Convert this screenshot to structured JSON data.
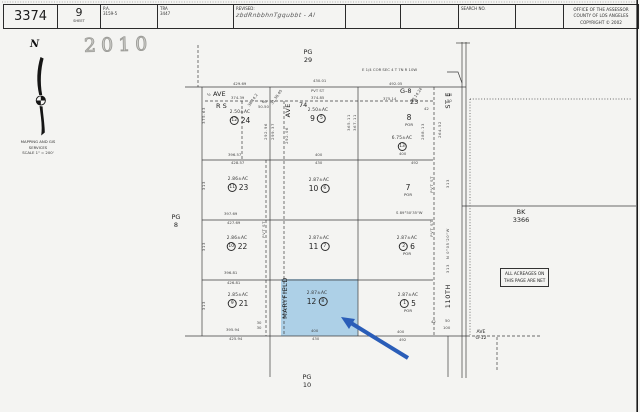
{
  "header": {
    "map_book": "3374",
    "sheet_number": "9",
    "sheet_label": "SHEET",
    "pa_label": "P.A.",
    "pa_value": "3159-5",
    "tra_label": "TRA",
    "tra_value": "3447",
    "revised_label": "REVISED:",
    "revised_note": "zbdRnbbhnTgqubbt - Al",
    "search_label": "SEARCH NO.",
    "office_line1": "OFFICE OF THE ASSESSOR",
    "office_line2": "COUNTY OF LOS ANGELES",
    "office_line3": "COPYRIGHT © 2002"
  },
  "stamp": "2010",
  "compass": {
    "n": "N",
    "caption": "MAPPING AND GIS\nSERVICES\nSCALE 1\" = 200'"
  },
  "note_box": "ALL ACREAGES ON\nTHIS PAGE ARE NET",
  "colors": {
    "highlight": "#a9cde6",
    "arrow": "#2a5db8",
    "line": "#3c3c3c"
  },
  "map": {
    "labels": [
      {
        "n": "pg-29",
        "t": "PG\n29",
        "x": 308,
        "y": 49,
        "c": "md ctr pre"
      },
      {
        "n": "pg-8",
        "t": "PG\n8",
        "x": 176,
        "y": 214,
        "c": "md ctr pre"
      },
      {
        "n": "pg-10",
        "t": "PG\n10",
        "x": 307,
        "y": 374,
        "c": "md ctr pre"
      },
      {
        "n": "bk-3366",
        "t": "BK\n3366",
        "x": 521,
        "y": 209,
        "c": "md ctr pre"
      },
      {
        "n": "ave-g12-label",
        "t": "AVE\nG-12",
        "x": 481,
        "y": 330,
        "c": "sm ctr pre"
      },
      {
        "n": "quarter-corner-note",
        "t": "E 1/4 COR SEC 4 T 7N R 10W",
        "x": 362,
        "y": 68,
        "c": "tiny"
      },
      {
        "n": "ave-west-prefix",
        "t": "½",
        "x": 207,
        "y": 93,
        "c": "tiny"
      },
      {
        "n": "ave-west-label",
        "t": "AVE",
        "x": 213,
        "y": 91,
        "c": "md"
      },
      {
        "n": "pvt-st-top",
        "t": "PVT ST",
        "x": 311,
        "y": 89,
        "c": "tiny"
      },
      {
        "n": "ave-g8-label",
        "t": "G-8",
        "x": 400,
        "y": 88,
        "c": "md"
      },
      {
        "n": "rs-note",
        "t": "R S",
        "x": 216,
        "y": 103,
        "c": "md"
      },
      {
        "n": "tract-74",
        "t": "74",
        "x": 299,
        "y": 102,
        "c": "md"
      },
      {
        "n": "lot-23-right",
        "t": "23",
        "x": 410,
        "y": 99,
        "c": "md"
      },
      {
        "n": "dim",
        "t": "429.69",
        "x": 233,
        "y": 82,
        "c": "tiny"
      },
      {
        "n": "dim",
        "t": "374.39",
        "x": 231,
        "y": 96,
        "c": "tiny"
      },
      {
        "n": "dim",
        "t": "430.01",
        "x": 313,
        "y": 79,
        "c": "tiny"
      },
      {
        "n": "dim",
        "t": "374.85",
        "x": 311,
        "y": 96,
        "c": "tiny"
      },
      {
        "n": "dim",
        "t": "492.05",
        "x": 389,
        "y": 82,
        "c": "tiny"
      },
      {
        "n": "dim",
        "t": "375.14",
        "x": 383,
        "y": 97,
        "c": "tiny"
      },
      {
        "n": "street-ave-central",
        "t": "AVE",
        "x": 285,
        "y": 103,
        "c": "md vert"
      },
      {
        "n": "street-maryfield",
        "t": "MARYFIELD",
        "x": 282,
        "y": 277,
        "c": "md vert"
      },
      {
        "n": "street-st-e",
        "t": "ST E",
        "x": 445,
        "y": 92,
        "c": "md vert"
      },
      {
        "n": "street-110th",
        "t": "110TH",
        "x": 445,
        "y": 284,
        "c": "md vert"
      },
      {
        "n": "pvt-st-central",
        "t": "PVT ST",
        "x": 262,
        "y": 221,
        "c": "tiny vert"
      },
      {
        "n": "pvt-st-right-upper",
        "t": "PVT ST",
        "x": 430,
        "y": 176,
        "c": "tiny vert"
      },
      {
        "n": "pvt-st-right-lower",
        "t": "PVT ST",
        "x": 430,
        "y": 220,
        "c": "tiny vert"
      },
      {
        "n": "dim",
        "t": "365.11",
        "x": 347,
        "y": 114,
        "c": "tiny vert"
      },
      {
        "n": "dim",
        "t": "367.11",
        "x": 353,
        "y": 114,
        "c": "tiny vert"
      },
      {
        "n": "dim",
        "t": "288.13",
        "x": 421,
        "y": 123,
        "c": "tiny vert"
      },
      {
        "n": "dim",
        "t": "264.52",
        "x": 438,
        "y": 121,
        "c": "tiny vert"
      },
      {
        "n": "dim",
        "t": "292.96",
        "x": 264,
        "y": 123,
        "c": "tiny vert"
      },
      {
        "n": "dim",
        "t": "299.37",
        "x": 271,
        "y": 123,
        "c": "tiny vert"
      },
      {
        "n": "dim",
        "t": "292.06",
        "x": 285,
        "y": 127,
        "c": "tiny vert"
      },
      {
        "n": "dim",
        "t": "375.63",
        "x": 202,
        "y": 107,
        "c": "tiny vert"
      },
      {
        "n": "dim",
        "t": "313",
        "x": 202,
        "y": 181,
        "c": "tiny vert"
      },
      {
        "n": "dim",
        "t": "313",
        "x": 202,
        "y": 242,
        "c": "tiny vert"
      },
      {
        "n": "dim",
        "t": "313",
        "x": 202,
        "y": 301,
        "c": "tiny vert"
      },
      {
        "n": "dim",
        "t": "313",
        "x": 446,
        "y": 179,
        "c": "tiny vert"
      },
      {
        "n": "dim",
        "t": "313",
        "x": 446,
        "y": 264,
        "c": "tiny vert"
      },
      {
        "n": "bearing",
        "t": "N 0°05'20\"W",
        "x": 446,
        "y": 228,
        "c": "tiny vert"
      },
      {
        "n": "dim",
        "t": "100",
        "x": 445,
        "y": 93,
        "c": "tiny"
      },
      {
        "n": "dim",
        "t": "50",
        "x": 447,
        "y": 99,
        "c": "tiny"
      },
      {
        "n": "dim",
        "t": "60",
        "x": 262,
        "y": 100,
        "c": "tiny"
      },
      {
        "n": "dim",
        "t": "50.50",
        "x": 258,
        "y": 105,
        "c": "tiny"
      },
      {
        "n": "dim",
        "t": "38.14.2",
        "x": 249,
        "y": 104,
        "c": "tiny ang"
      },
      {
        "n": "dim",
        "t": "31.38.40",
        "x": 272,
        "y": 102,
        "c": "tiny ang"
      },
      {
        "n": "dim",
        "t": "39.14.24",
        "x": 412,
        "y": 100,
        "c": "tiny ang"
      },
      {
        "n": "dim",
        "t": "42",
        "x": 424,
        "y": 107,
        "c": "tiny"
      },
      {
        "n": "dim",
        "t": "396.57",
        "x": 228,
        "y": 153,
        "c": "tiny"
      },
      {
        "n": "dim",
        "t": "428.57",
        "x": 231,
        "y": 161,
        "c": "tiny"
      },
      {
        "n": "dim",
        "t": "400",
        "x": 315,
        "y": 153,
        "c": "tiny"
      },
      {
        "n": "dim",
        "t": "430",
        "x": 315,
        "y": 161,
        "c": "tiny"
      },
      {
        "n": "dim",
        "t": "400",
        "x": 399,
        "y": 152,
        "c": "tiny"
      },
      {
        "n": "dim",
        "t": "492",
        "x": 411,
        "y": 161,
        "c": "tiny"
      },
      {
        "n": "dim",
        "t": "397.69",
        "x": 224,
        "y": 212,
        "c": "tiny"
      },
      {
        "n": "dim",
        "t": "427.69",
        "x": 227,
        "y": 221,
        "c": "tiny"
      },
      {
        "n": "bearing",
        "t": "S 89°50'35\"W",
        "x": 396,
        "y": 211,
        "c": "tiny"
      },
      {
        "n": "dim",
        "t": "396.81",
        "x": 224,
        "y": 271,
        "c": "tiny"
      },
      {
        "n": "dim",
        "t": "426.81",
        "x": 227,
        "y": 281,
        "c": "tiny"
      },
      {
        "n": "dim",
        "t": "395.94",
        "x": 226,
        "y": 328,
        "c": "tiny"
      },
      {
        "n": "dim",
        "t": "425.94",
        "x": 229,
        "y": 337,
        "c": "tiny"
      },
      {
        "n": "dim",
        "t": "400",
        "x": 311,
        "y": 329,
        "c": "tiny"
      },
      {
        "n": "dim",
        "t": "430",
        "x": 312,
        "y": 337,
        "c": "tiny"
      },
      {
        "n": "dim",
        "t": "400",
        "x": 397,
        "y": 330,
        "c": "tiny"
      },
      {
        "n": "dim",
        "t": "492",
        "x": 399,
        "y": 338,
        "c": "tiny"
      },
      {
        "n": "dim",
        "t": "30\n30",
        "x": 259,
        "y": 321,
        "c": "tiny ctr pre"
      },
      {
        "n": "dim",
        "t": "42",
        "x": 431,
        "y": 320,
        "c": "tiny"
      },
      {
        "n": "dim",
        "t": "50",
        "x": 445,
        "y": 319,
        "c": "tiny"
      },
      {
        "n": "dim",
        "t": "100",
        "x": 443,
        "y": 326,
        "c": "tiny"
      }
    ],
    "parcels": [
      {
        "x": 240,
        "y": 110,
        "ac": "2.50±AC",
        "pre": "12",
        "lot": "24"
      },
      {
        "x": 318,
        "y": 108,
        "ac": "2.50±AC",
        "lot": "9",
        "post": "5"
      },
      {
        "x": 409,
        "y": 112,
        "lot": "8",
        "sub": "POR"
      },
      {
        "x": 402,
        "y": 136,
        "ac": "6.75±AC",
        "pre": "13"
      },
      {
        "x": 238,
        "y": 177,
        "ac": "2.86±AC",
        "pre": "11",
        "lot": "23"
      },
      {
        "x": 319,
        "y": 178,
        "ac": "2.87±AC",
        "lot": "10",
        "post": "6"
      },
      {
        "x": 408,
        "y": 182,
        "lot": "7",
        "sub": "POR"
      },
      {
        "x": 237,
        "y": 236,
        "ac": "2.86±AC",
        "pre": "10",
        "lot": "22"
      },
      {
        "x": 319,
        "y": 236,
        "ac": "2.87±AC",
        "lot": "11",
        "post": "7"
      },
      {
        "x": 407,
        "y": 236,
        "ac": "2.87±AC",
        "pre": "2",
        "lot": "6",
        "sub": "POR"
      },
      {
        "x": 238,
        "y": 293,
        "ac": "2.85±AC",
        "pre": "9",
        "lot": "21"
      },
      {
        "x": 317,
        "y": 291,
        "ac": "2.87±AC",
        "lot": "12",
        "post": "8",
        "highlighted": true
      },
      {
        "x": 408,
        "y": 293,
        "ac": "2.87±AC",
        "pre": "1",
        "lot": "5",
        "sub": "POR"
      }
    ]
  }
}
